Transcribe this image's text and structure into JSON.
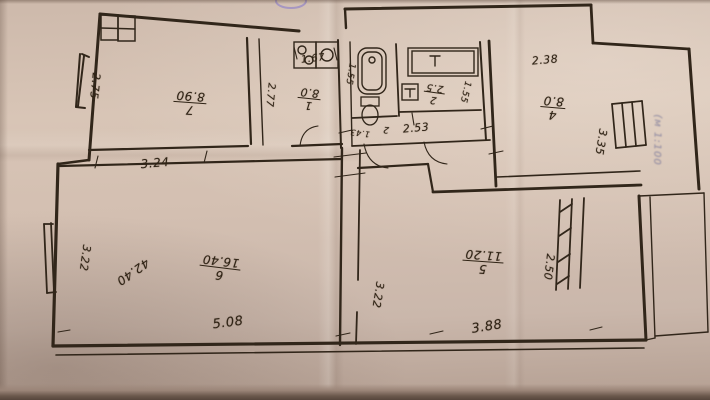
{
  "document": {
    "kind": "hand-drawn apartment floor plan (BTI style), photographed on aged paper",
    "scale_note": "(м 1:100",
    "total_area_note": "42.40"
  },
  "rooms": [
    {
      "number": "7",
      "area": "8.90"
    },
    {
      "number": "1",
      "area": "8.0"
    },
    {
      "number": "2",
      "area": "2.5"
    },
    {
      "number": "4",
      "area": "8.0"
    },
    {
      "number": "5",
      "area": "11.20"
    },
    {
      "number": "6",
      "area": "16.40"
    }
  ],
  "dimensions": {
    "room7_left_wall": "2.75",
    "hall_width": "3.24",
    "room1_width": "1.67",
    "room1_depth": "2.77",
    "wc_depth": "1.55",
    "wc_width": "1.43",
    "wc_mark": "2",
    "san_block_width": "2.53",
    "room4_width": "2.38",
    "room4_depth": "3.35",
    "bath_depth": "1.55",
    "room6_width": "5.08",
    "room6_left_wall": "3.22",
    "room5_width": "3.88",
    "room5_left_wall": "3.22",
    "balcony_window": "2.50"
  }
}
